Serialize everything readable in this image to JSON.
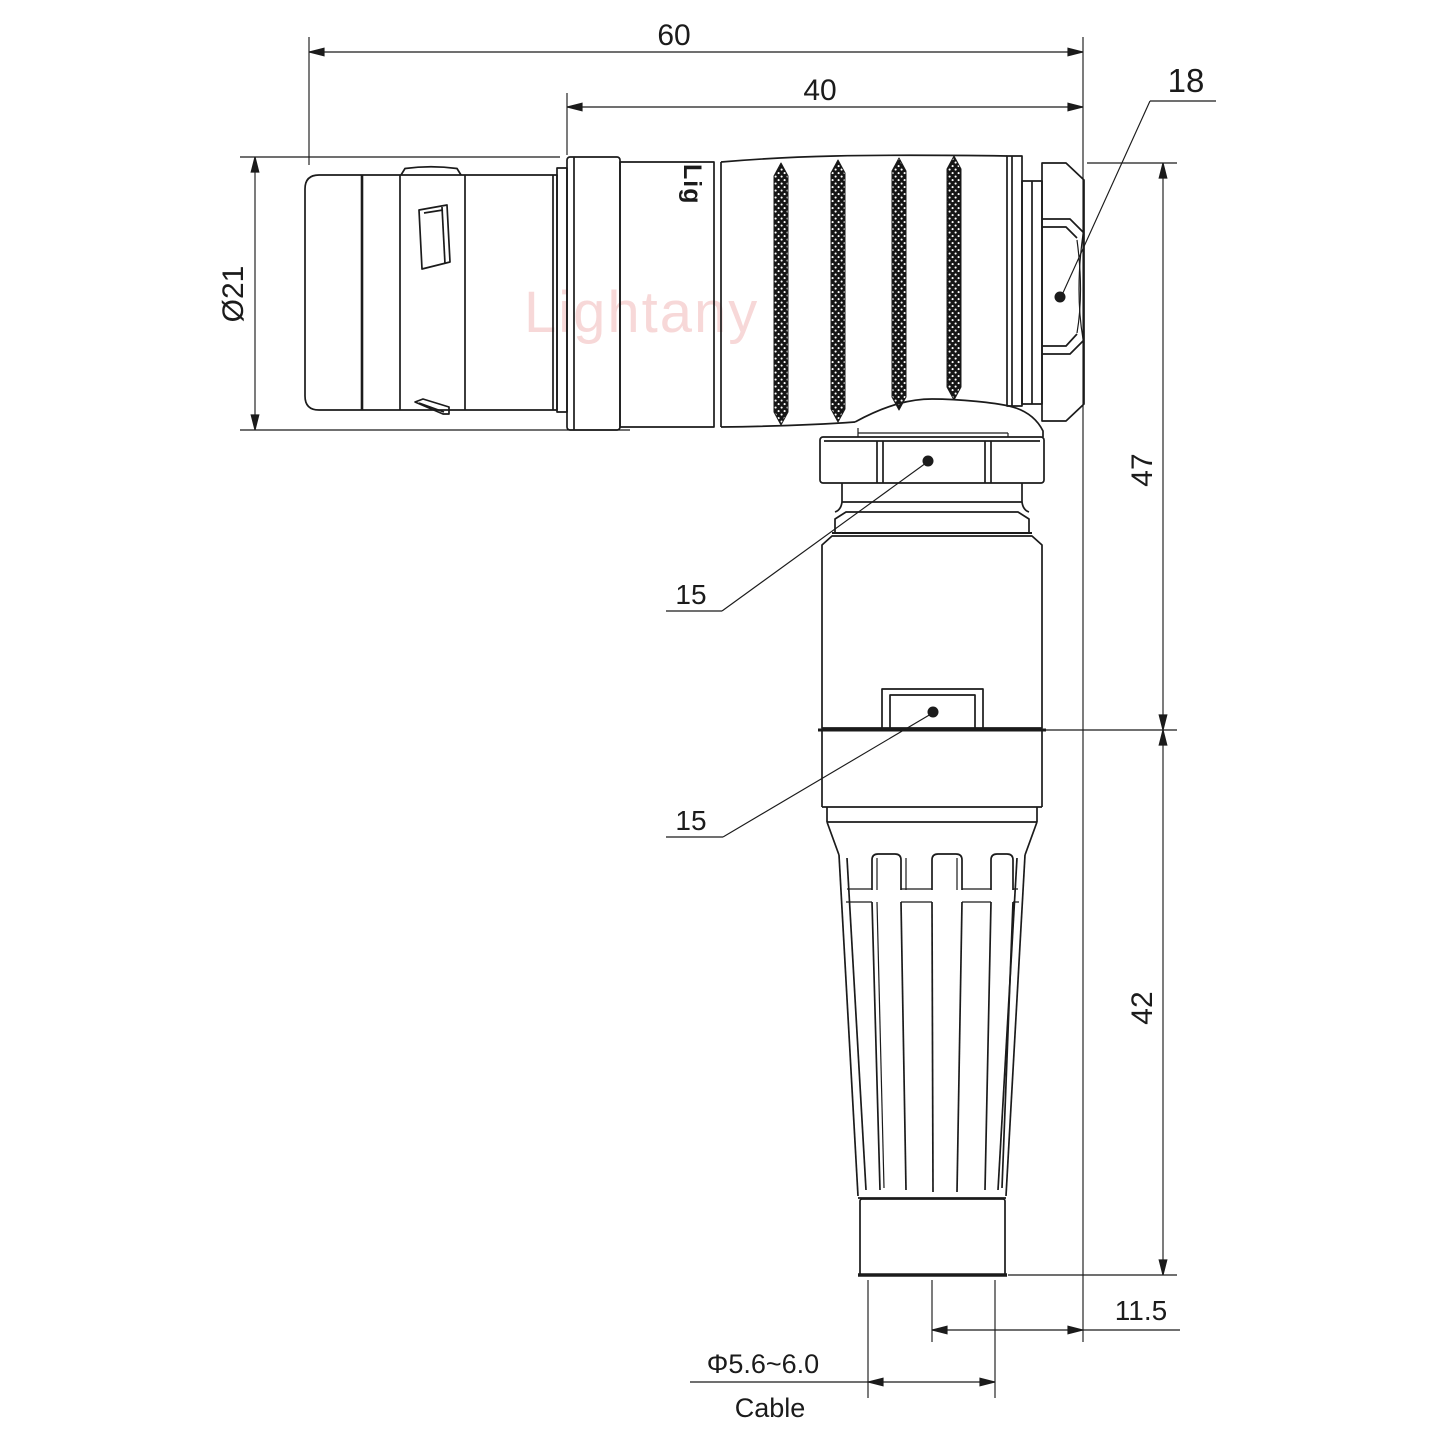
{
  "watermark": "Lightany",
  "engraving": "Lig",
  "dimensions": {
    "overall_length": "60",
    "grip_length": "40",
    "backnut_across_flats": "18",
    "front_diameter": "Ø21",
    "height_upper": "47",
    "coupling_nut_flats": "15",
    "latch_nut_flats": "15",
    "boot_height": "42",
    "side_offset": "11.5",
    "cable_diameter": "Φ5.6~6.0",
    "cable_label": "Cable"
  }
}
